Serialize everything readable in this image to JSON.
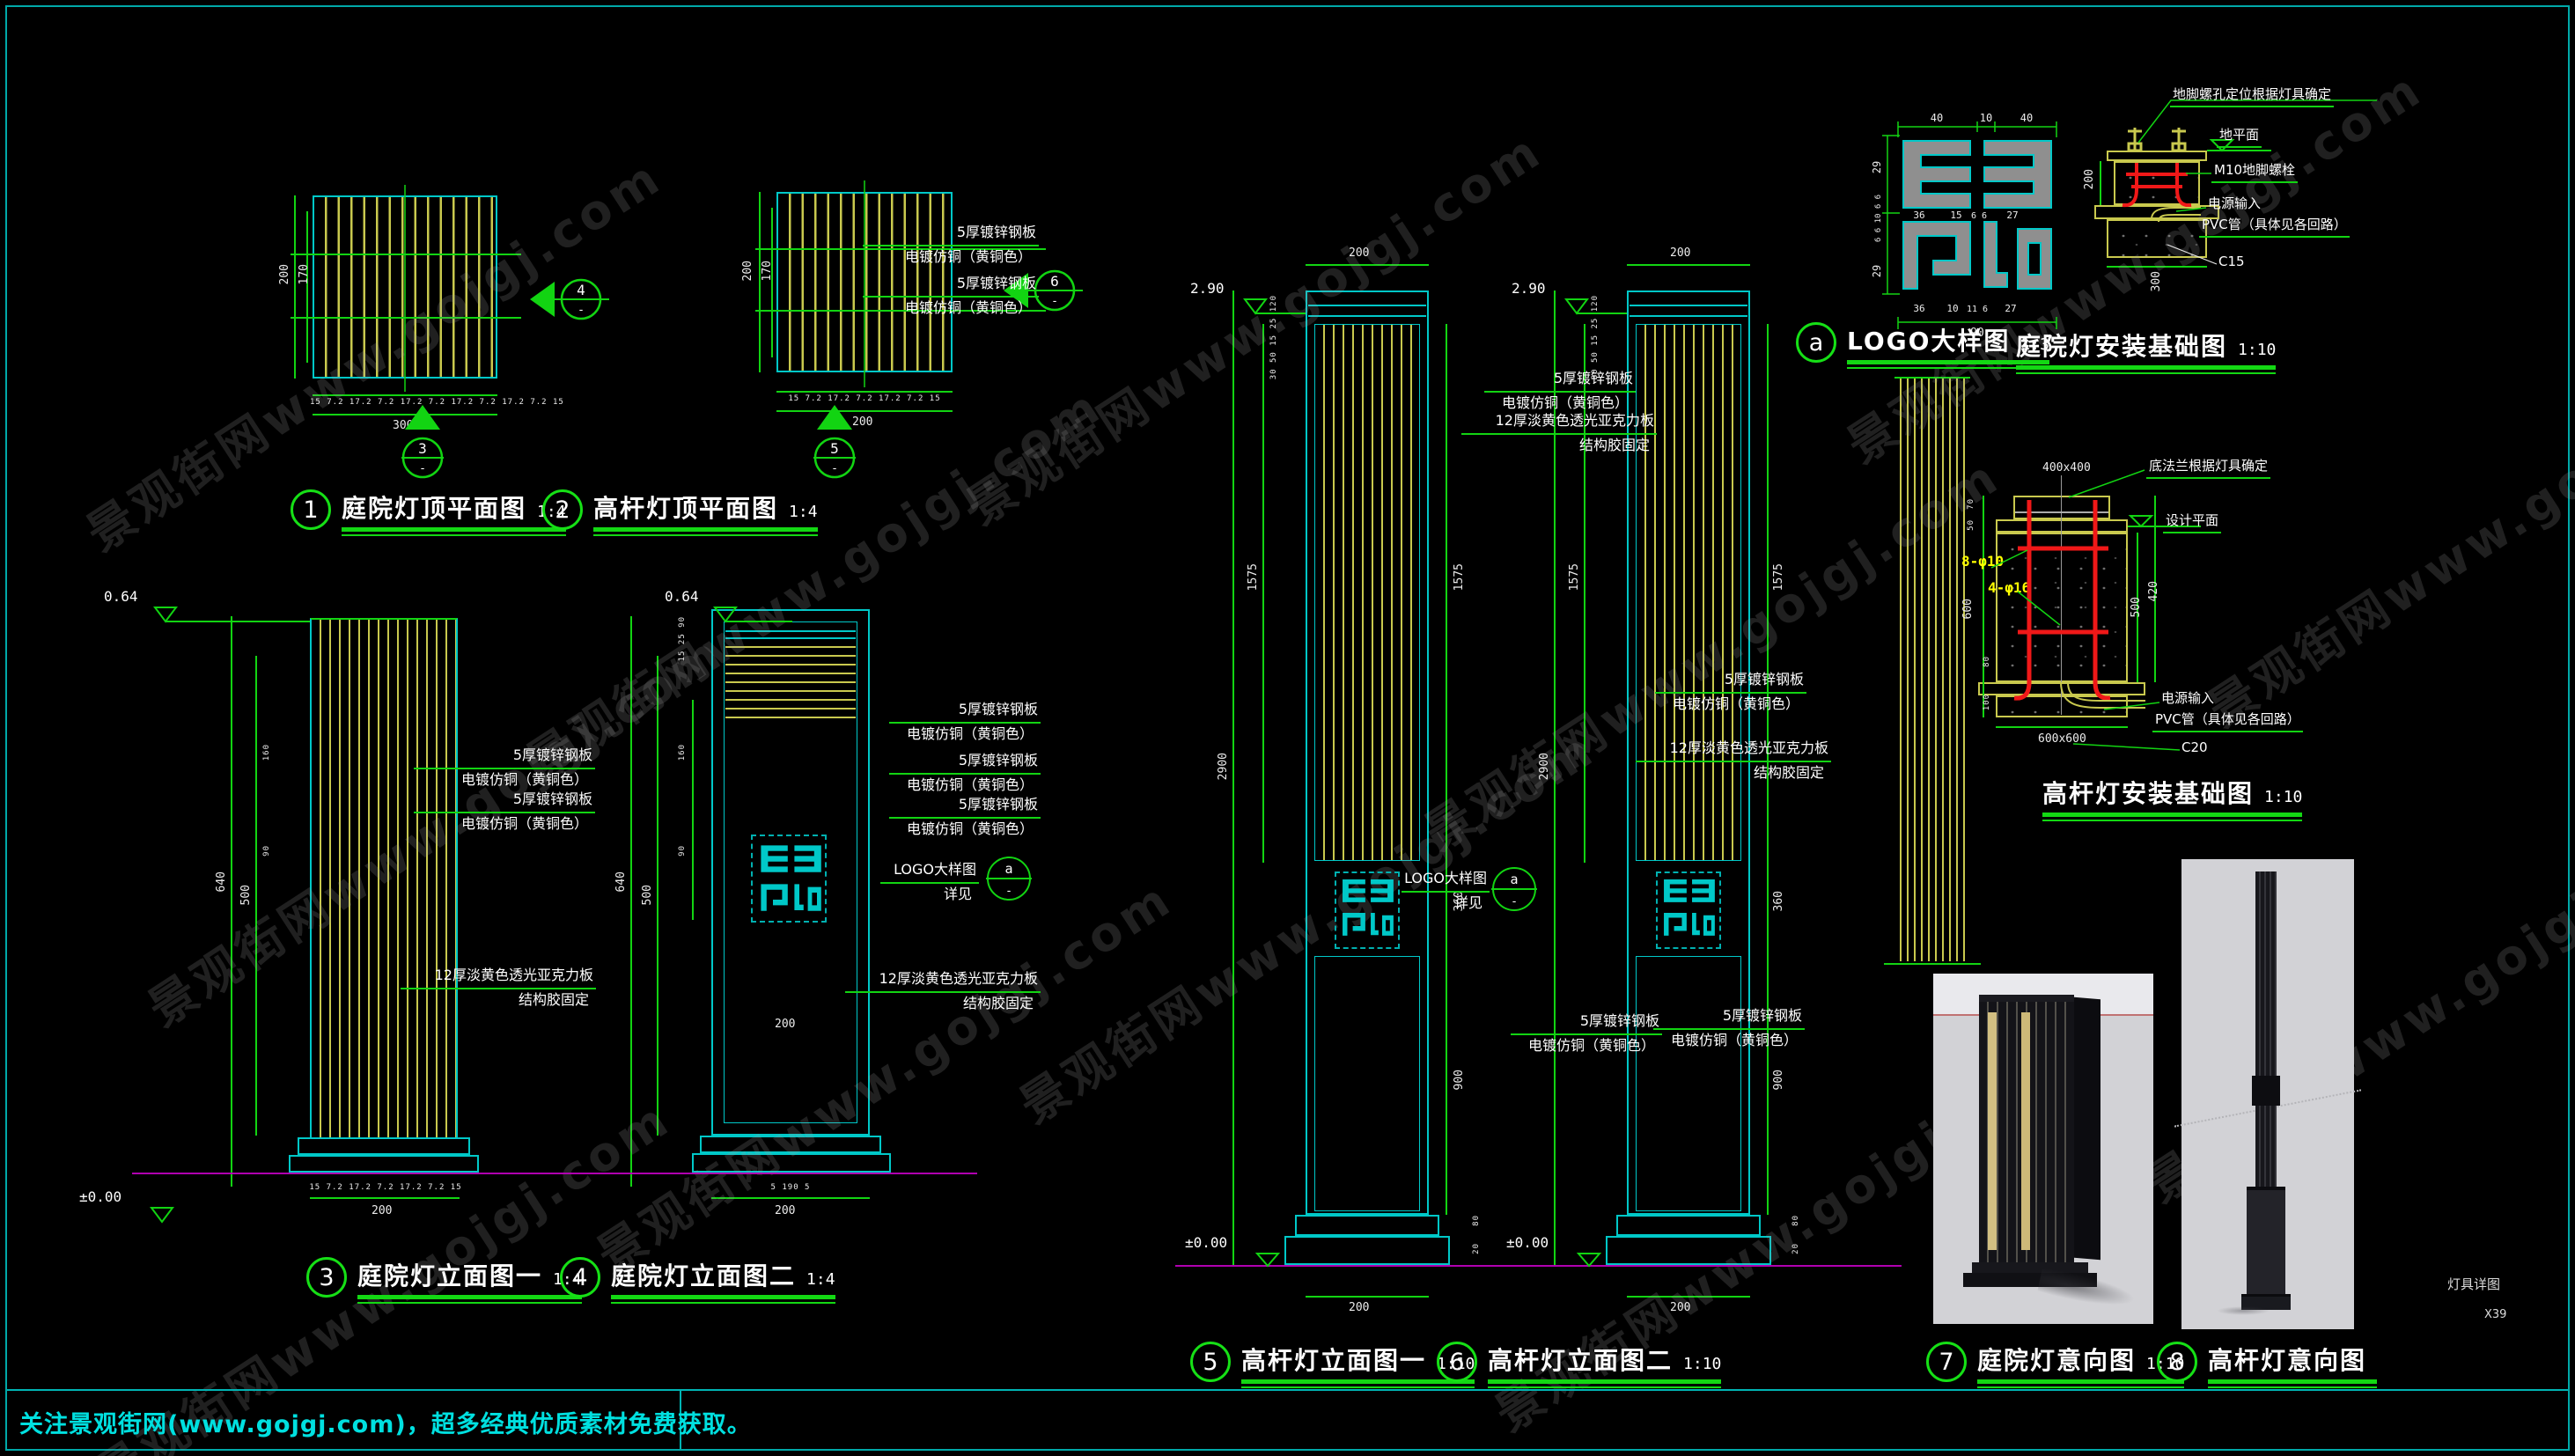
{
  "page": {
    "watermark": "景观街网www.gojgj.com",
    "footer": "关注景观街网(www.gojgj.com)，超多经典优质素材免费获取。",
    "sheet_label": "灯具详图",
    "sheet_no": "X39"
  },
  "materials": {
    "steel": "5厚镀锌钢板",
    "plating": "电镀仿铜（黄铜色）",
    "acrylic": "12厚淡黄色透光亚克力板",
    "acrylic_fix": "结构胶固定",
    "logo_ref": "LOGO大样图",
    "logo_see": "详见"
  },
  "levels": {
    "zero": "±0.00",
    "top_small": "0.64",
    "top_tall": "2.90"
  },
  "views": {
    "v1": {
      "num": "1",
      "title": "庭院灯顶平面图",
      "scale": "1:4",
      "dim_outer": "200",
      "dim_inner": "170",
      "chain": "15 7.2 17.2 7.2 17.2 7.2 17.2 7.2 17.2 7.2 15",
      "total": "300",
      "marker_below": "3",
      "marker_side": "4"
    },
    "v2": {
      "num": "2",
      "title": "高杆灯顶平面图",
      "scale": "1:4",
      "dim_outer": "200",
      "dim_inner": "170",
      "chain": "15 7.2 17.2 7.2 17.2 7.2 15",
      "total": "200",
      "marker_below": "5",
      "marker_side": "6"
    },
    "v3": {
      "num": "3",
      "title": "庭院灯立面图一",
      "scale": "1:4",
      "dim_total": "640",
      "dim_inner": "500",
      "dim_top1": "160",
      "dim_top2": "90",
      "chain": "15 7.2 17.2 7.2 17.2 7.2 15",
      "bottom_total": "200"
    },
    "v4": {
      "num": "4",
      "title": "庭院灯立面图二",
      "scale": "1:4",
      "dim_total": "640",
      "dim_inner": "500",
      "dim_top1": "160",
      "dim_top2": "90",
      "smalls_top": "15 25 90",
      "inner_width": "200",
      "bottom_chain": "5   190   5",
      "bottom_total": "200"
    },
    "v5": {
      "num": "5",
      "title": "高杆灯立面图一",
      "scale": "1:10",
      "top_width": "200",
      "dim_total": "2900",
      "dim_slat": "1575",
      "dim_logo": "360",
      "dim_lower": "900",
      "smalls_left": "30 50 15 25 120",
      "small_b1": "80",
      "small_b2": "20",
      "bottom_total": "200"
    },
    "v6": {
      "num": "6",
      "title": "高杆灯立面图二",
      "scale": "1:10",
      "top_width": "200",
      "dim_total": "2900",
      "dim_slat": "1575",
      "dim_logo": "360",
      "dim_lower": "900",
      "smalls_left": "30 50 15 25 120",
      "small_b1": "80",
      "small_b2": "20",
      "bottom_total": "200"
    },
    "v7": {
      "num": "7",
      "title": "庭院灯意向图",
      "scale": "1:10"
    },
    "v8": {
      "num": "8",
      "title": "高杆灯意向图",
      "scale": ""
    }
  },
  "logo": {
    "num": "a",
    "title": "LOGO大样图",
    "scale": "1:3",
    "dims_top": [
      "40",
      "10",
      "40"
    ],
    "dims_left": [
      "29",
      "6 6 10 6 6",
      "29"
    ],
    "dims_mid": [
      "36",
      "15",
      "6 6",
      "27"
    ],
    "dims_bottom": [
      "36",
      "10",
      "11 6",
      "27"
    ],
    "total": "90"
  },
  "base1": {
    "title": "庭院灯安装基础图",
    "scale": "1:10",
    "labels": {
      "anchor": "地脚螺孔定位根据灯具确定",
      "ground": "地平面",
      "bolt": "M10地脚螺栓",
      "power": "电源输入",
      "pvc": "PVC管（具体见各回路）",
      "concrete": "C15"
    },
    "dim_depth": "200",
    "dim_width": "300"
  },
  "base2": {
    "title": "高杆灯安装基础图",
    "scale": "1:10",
    "labels": {
      "flange": "底法兰根据灯具确定",
      "design": "设计平面",
      "rebar1": "8-φ10",
      "rebar2": "4-φ16",
      "power": "电源输入",
      "pvc": "PVC管（具体见各回路）",
      "concrete": "C20"
    },
    "dim_top": "400x400",
    "dims_left": [
      "70",
      "50",
      "600",
      "80",
      "100"
    ],
    "dims_right": [
      "500",
      "420"
    ],
    "dim_bottom": "600x600"
  }
}
